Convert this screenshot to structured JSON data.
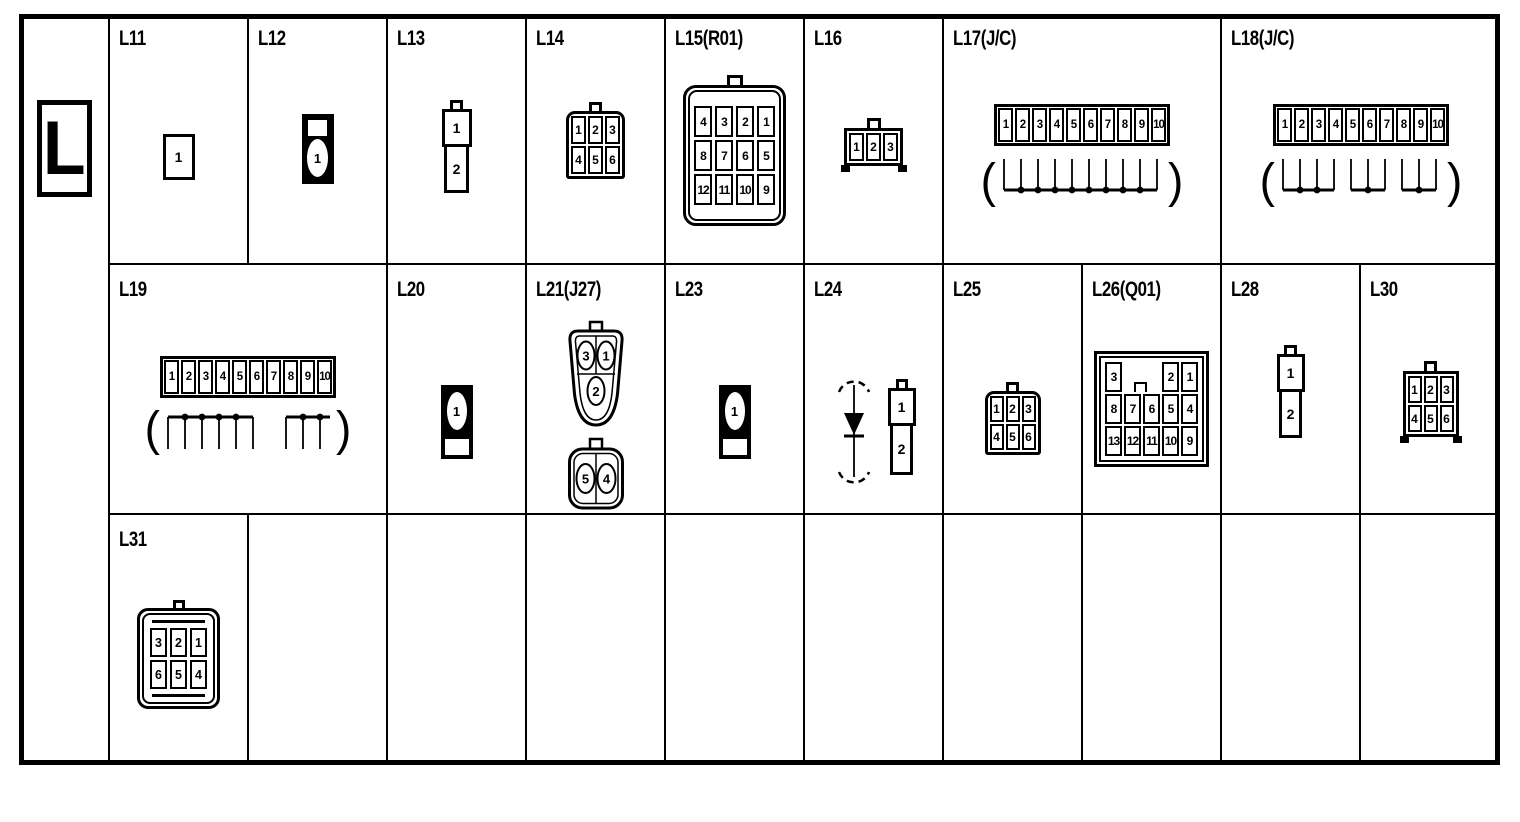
{
  "sheet": {
    "section_letter": "L",
    "paren_open": "(",
    "paren_close": ")"
  },
  "colors": {
    "ink": "#000000",
    "paper": "#ffffff"
  },
  "connectors": {
    "L11": {
      "label": "L11",
      "pins": [
        "1"
      ]
    },
    "L12": {
      "label": "L12",
      "pins": [
        "1"
      ]
    },
    "L13": {
      "label": "L13",
      "pins": [
        "1",
        "2"
      ]
    },
    "L14": {
      "label": "L14",
      "pins": [
        "1",
        "2",
        "3",
        "4",
        "5",
        "6"
      ]
    },
    "L15": {
      "label": "L15(R01)",
      "pins": [
        "4",
        "3",
        "2",
        "1",
        "8",
        "7",
        "6",
        "5",
        "12",
        "11",
        "10",
        "9"
      ]
    },
    "L16": {
      "label": "L16",
      "pins": [
        "1",
        "2",
        "3"
      ]
    },
    "L17": {
      "label": "L17(J/C)",
      "pins": [
        "1",
        "2",
        "3",
        "4",
        "5",
        "6",
        "7",
        "8",
        "9",
        "10"
      ],
      "joint_groups": [
        [
          "1",
          "2",
          "3",
          "4",
          "5",
          "6",
          "7",
          "8",
          "9",
          "10"
        ]
      ]
    },
    "L18": {
      "label": "L18(J/C)",
      "pins": [
        "1",
        "2",
        "3",
        "4",
        "5",
        "6",
        "7",
        "8",
        "9",
        "10"
      ],
      "joint_groups": [
        [
          "1",
          "2",
          "3",
          "4"
        ],
        [
          "5",
          "6",
          "7"
        ],
        [
          "8",
          "9",
          "10"
        ]
      ]
    },
    "L19": {
      "label": "L19",
      "pins": [
        "1",
        "2",
        "3",
        "4",
        "5",
        "6",
        "7",
        "8",
        "9",
        "10"
      ],
      "joint_groups": [
        [
          "1",
          "2",
          "3",
          "4",
          "5",
          "6"
        ],
        [
          "7",
          "8",
          "9"
        ]
      ]
    },
    "L20": {
      "label": "L20",
      "pins": [
        "1"
      ]
    },
    "L21": {
      "label": "L21(J27)",
      "pins": [
        "3",
        "1",
        "2",
        "5",
        "4"
      ]
    },
    "L23": {
      "label": "L23",
      "pins": [
        "1"
      ]
    },
    "L24": {
      "label": "L24",
      "pins": [
        "1",
        "2"
      ],
      "symbol": "diode"
    },
    "L25": {
      "label": "L25",
      "pins": [
        "1",
        "2",
        "3",
        "4",
        "5",
        "6"
      ]
    },
    "L26": {
      "label": "L26(Q01)",
      "pins": [
        "3",
        "2",
        "1",
        "8",
        "7",
        "6",
        "5",
        "4",
        "13",
        "12",
        "11",
        "10",
        "9"
      ]
    },
    "L28": {
      "label": "L28",
      "pins": [
        "1",
        "2"
      ]
    },
    "L30": {
      "label": "L30",
      "pins": [
        "1",
        "2",
        "3",
        "4",
        "5",
        "6"
      ]
    },
    "L31": {
      "label": "L31",
      "pins": [
        "3",
        "2",
        "1",
        "6",
        "5",
        "4"
      ]
    }
  }
}
